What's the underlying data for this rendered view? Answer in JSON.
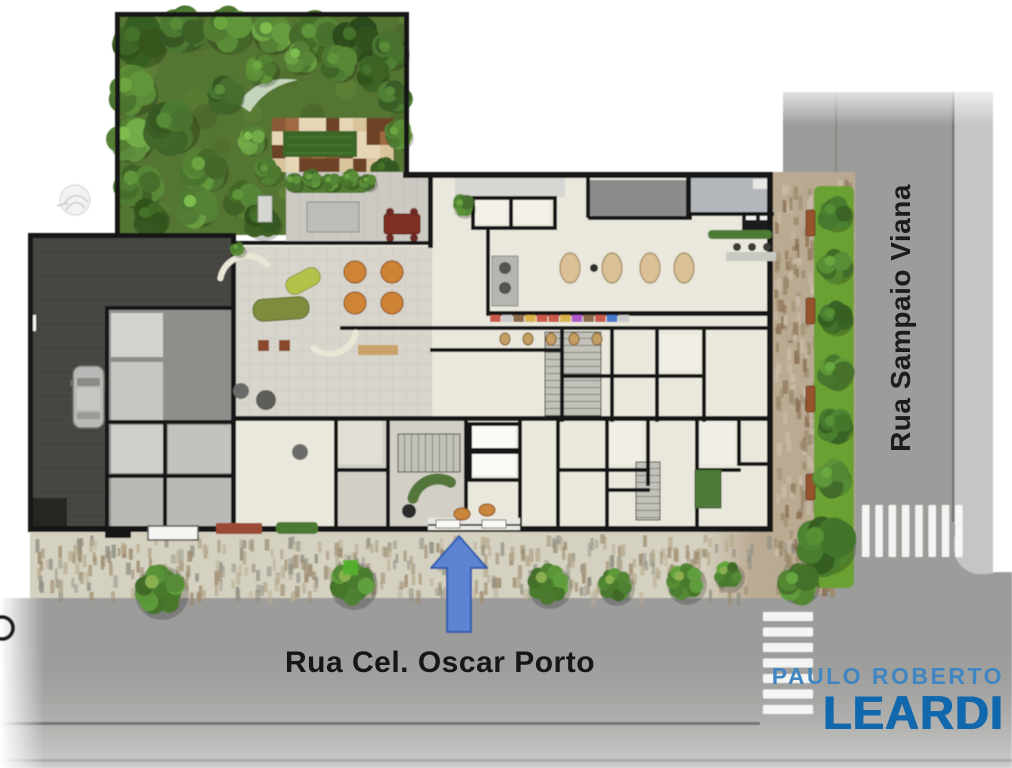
{
  "streets": {
    "bottom": "Rua Cel. Oscar Porto",
    "right": "Rua Sampaio Viana"
  },
  "logo": {
    "line1": "PAULO ROBERTO",
    "line2": "LEARDI",
    "color1": "#3f86c2",
    "color2": "#1268ad"
  },
  "arrow": {
    "cx": 459,
    "tipY": 536,
    "headBaseY": 568,
    "baseY": 632,
    "halfHead": 28,
    "halfShaft": 12,
    "fill": "#5b84d2",
    "stroke": "#2d5cae"
  },
  "colors": {
    "road": "#9c9c9a",
    "roadFar": "#c5c6c4",
    "curb": "#757573",
    "sidewalk": "#d5d1c0",
    "brick": "#b7a68e",
    "gardenBase": "#557431",
    "lawn": "#3a6628",
    "terrace": "#cbc9c1",
    "cream": "#eae8dc",
    "loungeFloor": "#d8d6cc",
    "garageDark": "#454543",
    "garageMid": "#8e8e8a",
    "wall": "#161614",
    "roofDark": "#8a8c8c",
    "roofLight": "#b3b7bb",
    "stripGreen": "#6aa133",
    "crosswalk": "#fbfbf9"
  },
  "crosswalks": {
    "right": {
      "x": 862,
      "y": 505,
      "stripeW": 7.5,
      "stripeH": 52,
      "count": 8,
      "step": 13.3,
      "dir": "v"
    },
    "bottom": {
      "x": 763,
      "y": 612,
      "stripeW": 50,
      "stripeH": 9,
      "count": 7,
      "step": 15.5,
      "dir": "h"
    }
  },
  "garden": {
    "outline": "M118,14 L405,14 L405,172 L286,172 L286,235 L118,235 Z",
    "checker": {
      "x": 272,
      "y": 118,
      "cols": 9,
      "rows": 4,
      "cell": 13.5,
      "palette": [
        "#6e4226",
        "#8a5a38",
        "#a06a42",
        "#e5d6b6",
        "#d9c49c"
      ]
    },
    "lawn": [
      283,
      131,
      74,
      26
    ],
    "pathCrescent": "M238,104 Q258,74 298,80 Q266,86 250,112 Z",
    "trees": [
      [
        140,
        42,
        26
      ],
      [
        183,
        30,
        22
      ],
      [
        228,
        30,
        24
      ],
      [
        272,
        34,
        20
      ],
      [
        316,
        38,
        24
      ],
      [
        356,
        40,
        22
      ],
      [
        390,
        52,
        18
      ],
      [
        132,
        92,
        24
      ],
      [
        130,
        140,
        22
      ],
      [
        138,
        185,
        24
      ],
      [
        150,
        218,
        18
      ],
      [
        172,
        128,
        26
      ],
      [
        205,
        170,
        22
      ],
      [
        196,
        207,
        20
      ],
      [
        243,
        200,
        18
      ],
      [
        262,
        222,
        18
      ],
      [
        225,
        95,
        18
      ],
      [
        262,
        70,
        16
      ],
      [
        300,
        58,
        16
      ],
      [
        338,
        64,
        18
      ],
      [
        372,
        74,
        16
      ],
      [
        395,
        96,
        16
      ],
      [
        398,
        135,
        14
      ],
      [
        252,
        140,
        14
      ],
      [
        268,
        172,
        13
      ],
      [
        385,
        170,
        13
      ]
    ],
    "treePalette": [
      "#33541f",
      "#41662a",
      "#507a30",
      "#5d8c3a",
      "#486f2c"
    ],
    "fadedTreeSymbol": {
      "x": 75,
      "y": 200,
      "r": 15
    }
  },
  "terrace": {
    "rect": [
      286,
      172,
      146,
      71
    ],
    "hedge": [
      290,
      176,
      78,
      17
    ],
    "hedgePlants": [
      [
        293,
        182,
        9
      ],
      [
        312,
        179,
        9
      ],
      [
        331,
        182,
        9
      ],
      [
        350,
        179,
        9
      ],
      [
        368,
        182,
        8
      ]
    ],
    "pergola": [
      307,
      202,
      52,
      30
    ],
    "grayLounger": [
      258,
      196,
      14,
      26
    ],
    "redTable": [
      384,
      214,
      36,
      20
    ],
    "redChairs": [
      [
        390,
        212
      ],
      [
        414,
        212
      ],
      [
        390,
        238
      ],
      [
        414,
        238
      ]
    ]
  },
  "garage": {
    "dark": [
      33,
      238,
      198,
      290
    ],
    "mid": [
      108,
      310,
      123,
      218
    ],
    "rooms": [
      [
        111,
        313,
        52,
        44,
        "#d2d2ce"
      ],
      [
        111,
        362,
        52,
        58,
        "#c6c6c2"
      ],
      [
        111,
        425,
        55,
        48,
        "#cfcfcb"
      ],
      [
        168,
        425,
        63,
        48,
        "#c2c2be"
      ],
      [
        111,
        478,
        120,
        48,
        "#b9b9b5"
      ]
    ],
    "storage": [
      33,
      498,
      34,
      28
    ],
    "gate": [
      28,
      315,
      8,
      16
    ],
    "car": {
      "x": 73,
      "y": 366,
      "w": 31,
      "h": 62
    }
  },
  "building": {
    "outline": "M236,243 L430,243 L430,175 L768,175 L768,526 L236,526 Z",
    "loungeFloor": [
      236,
      247,
      196,
      170
    ],
    "lobbyFloor": [
      338,
      420,
      130,
      106
    ],
    "roofs": [
      [
        590,
        180,
        96,
        36,
        "#8a8c8c"
      ],
      [
        691,
        178,
        82,
        34,
        "#b3b7bb"
      ],
      [
        455,
        177,
        110,
        20,
        "#d6d6d2"
      ],
      [
        753,
        179,
        18,
        10,
        "#e8e8e6"
      ]
    ],
    "rooms": [
      [
        474,
        200,
        34,
        24,
        "#f2f0e8"
      ],
      [
        512,
        200,
        38,
        24,
        "#f2f0e8"
      ],
      [
        472,
        426,
        44,
        22,
        "#fafaf6"
      ],
      [
        472,
        454,
        44,
        22,
        "#fafaf6"
      ],
      [
        338,
        420,
        44,
        44,
        "#e2e0d6"
      ],
      [
        608,
        420,
        35,
        44,
        "#f0eee6"
      ],
      [
        700,
        420,
        35,
        44,
        "#f0eee6"
      ],
      [
        660,
        335,
        40,
        36,
        "#f0eee6"
      ]
    ],
    "stairs": [
      {
        "x": 398,
        "y": 434,
        "w": 62,
        "h": 38,
        "dir": "v"
      },
      {
        "x": 545,
        "y": 332,
        "w": 56,
        "h": 84,
        "dir": "h"
      },
      {
        "x": 636,
        "y": 462,
        "w": 24,
        "h": 58,
        "dir": "h"
      }
    ],
    "entrance": {
      "patch": [
        428,
        518,
        92,
        12
      ],
      "glassY": 524,
      "doors": [
        [
          436,
          520,
          24,
          8
        ],
        [
          482,
          520,
          24,
          8
        ]
      ]
    },
    "serviceBlock": [
      742,
      212,
      30,
      20
    ],
    "serviceSlits": [
      [
        746,
        216,
        10,
        4
      ],
      [
        760,
        216,
        10,
        4
      ]
    ],
    "walls": [
      [
        115,
        12,
        294,
        5
      ],
      [
        115,
        12,
        5,
        223
      ],
      [
        404,
        12,
        5,
        165
      ],
      [
        403,
        172,
        370,
        6
      ],
      [
        767,
        172,
        6,
        360
      ],
      [
        30,
        526,
        743,
        6
      ],
      [
        28,
        233,
        208,
        5
      ],
      [
        28,
        233,
        5,
        299
      ],
      [
        231,
        233,
        5,
        299
      ],
      [
        231,
        241,
        201,
        4
      ],
      [
        428,
        172,
        5,
        76
      ],
      [
        471,
        196,
        86,
        4
      ],
      [
        471,
        196,
        4,
        34
      ],
      [
        553,
        196,
        4,
        34
      ],
      [
        509,
        196,
        4,
        34
      ],
      [
        471,
        226,
        86,
        4
      ],
      [
        486,
        230,
        4,
        85
      ],
      [
        486,
        311,
        287,
        5
      ],
      [
        340,
        326,
        433,
        4
      ],
      [
        430,
        348,
        130,
        4
      ],
      [
        560,
        330,
        4,
        92
      ],
      [
        610,
        330,
        4,
        92
      ],
      [
        655,
        330,
        4,
        92
      ],
      [
        702,
        330,
        4,
        92
      ],
      [
        560,
        374,
        146,
        4
      ],
      [
        231,
        416,
        542,
        5
      ],
      [
        334,
        416,
        4,
        114
      ],
      [
        386,
        416,
        4,
        114
      ],
      [
        464,
        416,
        4,
        114
      ],
      [
        518,
        416,
        4,
        114
      ],
      [
        556,
        416,
        4,
        114
      ],
      [
        605,
        416,
        4,
        114
      ],
      [
        646,
        416,
        4,
        70
      ],
      [
        695,
        416,
        4,
        114
      ],
      [
        737,
        416,
        4,
        50
      ],
      [
        334,
        468,
        56,
        4
      ],
      [
        464,
        448,
        58,
        4
      ],
      [
        556,
        468,
        93,
        4
      ],
      [
        605,
        488,
        45,
        4
      ],
      [
        695,
        468,
        46,
        4
      ],
      [
        737,
        462,
        36,
        4
      ],
      [
        105,
        306,
        130,
        4
      ],
      [
        105,
        306,
        4,
        222
      ],
      [
        105,
        420,
        130,
        4
      ],
      [
        163,
        420,
        4,
        108
      ],
      [
        105,
        474,
        126,
        4
      ],
      [
        468,
        422,
        54,
        4
      ],
      [
        468,
        422,
        4,
        60
      ],
      [
        518,
        422,
        4,
        60
      ],
      [
        468,
        450,
        54,
        4
      ],
      [
        468,
        478,
        54,
        4
      ],
      [
        586,
        178,
        4,
        40
      ],
      [
        686,
        175,
        5,
        45
      ],
      [
        588,
        216,
        104,
        4
      ],
      [
        690,
        212,
        84,
        4
      ],
      [
        105,
        530,
        26,
        8
      ]
    ],
    "furniture": [
      {
        "t": "oval",
        "x": 570,
        "y": 268,
        "rx": 10,
        "ry": 15,
        "f": "#d9c096",
        "s": "#a3875d"
      },
      {
        "t": "oval",
        "x": 612,
        "y": 268,
        "rx": 10,
        "ry": 15,
        "f": "#d9c096",
        "s": "#a3875d"
      },
      {
        "t": "oval",
        "x": 650,
        "y": 268,
        "rx": 10,
        "ry": 15,
        "f": "#d9c096",
        "s": "#a3875d"
      },
      {
        "t": "oval",
        "x": 684,
        "y": 268,
        "rx": 10,
        "ry": 15,
        "f": "#d9c096",
        "s": "#a3875d"
      },
      {
        "t": "circle",
        "x": 594,
        "y": 268,
        "r": 4,
        "f": "#2e2e2c"
      },
      {
        "t": "circle",
        "x": 355,
        "y": 272,
        "r": 11,
        "f": "#cf8436",
        "s": "#96591c"
      },
      {
        "t": "circle",
        "x": 392,
        "y": 272,
        "r": 11,
        "f": "#cf8436",
        "s": "#96591c"
      },
      {
        "t": "circle",
        "x": 355,
        "y": 303,
        "r": 11,
        "f": "#cf8436",
        "s": "#96591c"
      },
      {
        "t": "circle",
        "x": 392,
        "y": 303,
        "r": 11,
        "f": "#cf8436",
        "s": "#96591c"
      },
      {
        "t": "rrect",
        "x": 303,
        "y": 281,
        "w": 36,
        "h": 18,
        "rot": -28,
        "f": "#b5c24a",
        "s": "#8a9634"
      },
      {
        "t": "rrect",
        "x": 281,
        "y": 309,
        "w": 56,
        "h": 22,
        "rot": -4,
        "f": "#7d8d3c",
        "s": "#5d6b28"
      },
      {
        "t": "arc",
        "cx": 247,
        "cy": 283,
        "r": 27,
        "a1": 190,
        "a2": 320,
        "s": "#eae6d6",
        "w": 6
      },
      {
        "t": "arc",
        "cx": 330,
        "cy": 328,
        "r": 26,
        "a1": 10,
        "a2": 130,
        "s": "#eae6d6",
        "w": 6
      },
      {
        "t": "rect",
        "x": 258,
        "y": 340,
        "w": 11,
        "h": 11,
        "f": "#8a4a2c"
      },
      {
        "t": "rect",
        "x": 279,
        "y": 340,
        "w": 11,
        "h": 11,
        "f": "#8a4a2c"
      },
      {
        "t": "rect",
        "x": 358,
        "y": 345,
        "w": 40,
        "h": 10,
        "f": "#c8a268"
      },
      {
        "t": "circle",
        "x": 241,
        "y": 391,
        "r": 8,
        "f": "#6b6b67"
      },
      {
        "t": "circle",
        "x": 266,
        "y": 400,
        "r": 10,
        "f": "#5d5d59"
      },
      {
        "t": "circle",
        "x": 300,
        "y": 452,
        "r": 8,
        "f": "#6b6b67"
      },
      {
        "t": "rect",
        "x": 726,
        "y": 252,
        "w": 50,
        "h": 9,
        "f": "#c9c9c4"
      },
      {
        "t": "circle",
        "x": 737,
        "y": 247,
        "r": 4,
        "f": "#3a3a38"
      },
      {
        "t": "circle",
        "x": 752,
        "y": 247,
        "r": 4,
        "f": "#3a3a38"
      },
      {
        "t": "circle",
        "x": 767,
        "y": 247,
        "r": 4,
        "f": "#3a3a38"
      },
      {
        "t": "rect",
        "x": 492,
        "y": 256,
        "w": 26,
        "h": 50,
        "f": "#b5b5b1",
        "s": "#8a8a86"
      },
      {
        "t": "circle",
        "x": 505,
        "y": 268,
        "r": 6,
        "f": "#54544f"
      },
      {
        "t": "circle",
        "x": 505,
        "y": 288,
        "r": 6,
        "f": "#54544f"
      },
      {
        "t": "oval",
        "x": 505,
        "y": 339,
        "rx": 5,
        "ry": 6,
        "f": "#c49e63",
        "s": "#8a6a3a"
      },
      {
        "t": "oval",
        "x": 528,
        "y": 339,
        "rx": 5,
        "ry": 6,
        "f": "#c49e63",
        "s": "#8a6a3a"
      },
      {
        "t": "oval",
        "x": 551,
        "y": 339,
        "rx": 5,
        "ry": 6,
        "f": "#c49e63",
        "s": "#8a6a3a"
      },
      {
        "t": "oval",
        "x": 574,
        "y": 339,
        "rx": 5,
        "ry": 6,
        "f": "#c49e63",
        "s": "#8a6a3a"
      },
      {
        "t": "oval",
        "x": 597,
        "y": 339,
        "rx": 5,
        "ry": 6,
        "f": "#c49e63",
        "s": "#8a6a3a"
      },
      {
        "t": "shelf",
        "x": 490,
        "y": 315,
        "w": 140,
        "h": 7
      },
      {
        "t": "arc",
        "cx": 438,
        "cy": 505,
        "r": 26,
        "a1": 195,
        "a2": 300,
        "s": "#55763a",
        "w": 11
      },
      {
        "t": "circle",
        "x": 409,
        "y": 511,
        "r": 7,
        "f": "#2c2c2a"
      },
      {
        "t": "oval",
        "x": 462,
        "y": 514,
        "rx": 8,
        "ry": 6,
        "f": "#c9863c",
        "s": "#96591c"
      },
      {
        "t": "oval",
        "x": 487,
        "y": 510,
        "rx": 8,
        "ry": 6,
        "f": "#c9863c",
        "s": "#96591c"
      },
      {
        "t": "rect",
        "x": 695,
        "y": 470,
        "w": 26,
        "h": 38,
        "f": "#4e7a38",
        "s": "#3a5c28"
      }
    ],
    "interiorPlants": [
      [
        463,
        206,
        11
      ],
      [
        238,
        249,
        7
      ]
    ],
    "interiorHedges": [
      [
        708,
        230,
        64,
        9
      ]
    ]
  },
  "streetscape": {
    "greenStrip": [
      814,
      186,
      40,
      402
    ],
    "stripTrees": [
      [
        835,
        214,
        17
      ],
      [
        835,
        266,
        17
      ],
      [
        835,
        318,
        17
      ],
      [
        835,
        372,
        17
      ],
      [
        835,
        426,
        17
      ],
      [
        832,
        478,
        18
      ],
      [
        824,
        545,
        30
      ],
      [
        798,
        584,
        20
      ]
    ],
    "stripTreePalette": [
      "#3e6b28",
      "#4d7c2f"
    ],
    "benches": [
      [
        806,
        210,
        9,
        26
      ],
      [
        806,
        298,
        9,
        26
      ],
      [
        806,
        386,
        9,
        26
      ],
      [
        806,
        474,
        9,
        26
      ]
    ],
    "benchColor": "#97522e",
    "bottomShrubs": [
      [
        160,
        590,
        27
      ],
      [
        352,
        583,
        24
      ],
      [
        548,
        584,
        22
      ],
      [
        615,
        585,
        18
      ],
      [
        685,
        582,
        20
      ],
      [
        728,
        575,
        15
      ]
    ],
    "shrubColor": "#4a7a2e",
    "brightSquare": [
      343,
      560,
      15
    ],
    "canopy": [
      148,
      526,
      50,
      14
    ],
    "redAwning": [
      216,
      523,
      46,
      11
    ],
    "bottomHedge": [
      276,
      522,
      42,
      12
    ],
    "partialRing": {
      "x": 2,
      "y": 628,
      "r": 11
    }
  }
}
